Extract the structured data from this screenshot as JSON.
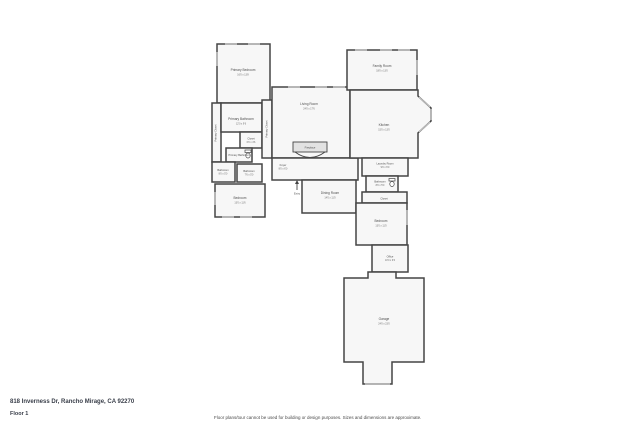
{
  "page": {
    "address": "818 Inverness Dr, Rancho Mirage, CA 92270",
    "floor_label": "Floor 1",
    "disclaimer": "Floor plans/tour cannot be used for building or design purposes. Sizes and dimensions are approximate."
  },
  "floorplan": {
    "rooms": [
      {
        "name": "Primary Bedroom",
        "dims": "16'0 x 13'8"
      },
      {
        "name": "Primary Bathroom",
        "dims": "12'0 x 9'6"
      },
      {
        "name": "Closet",
        "dims": "6'0 x 4'6"
      },
      {
        "name": "Primary Bathroom",
        "dims": ""
      },
      {
        "name": "Primary Closet",
        "dims": ""
      },
      {
        "name": "Primary Closet",
        "dims": ""
      },
      {
        "name": "Bathroom",
        "dims": "8'0 x 5'0"
      },
      {
        "name": "Bathroom",
        "dims": "7'6 x 5'0"
      },
      {
        "name": "Bedroom",
        "dims": "13'0 x 11'6"
      },
      {
        "name": "Living Room",
        "dims": "24'0 x 17'6"
      },
      {
        "name": "Fireplace",
        "dims": ""
      },
      {
        "name": "Foyer",
        "dims": "8'0 x 6'0"
      },
      {
        "name": "Entry",
        "dims": ""
      },
      {
        "name": "Dining Room",
        "dims": "14'0 x 11'0"
      },
      {
        "name": "Family Room",
        "dims": "18'0 x 13'0"
      },
      {
        "name": "Kitchen",
        "dims": "15'0 x 13'0"
      },
      {
        "name": "Laundry Room",
        "dims": "9'0 x 6'0"
      },
      {
        "name": "Bathroom",
        "dims": "8'0 x 5'0"
      },
      {
        "name": "Closet",
        "dims": ""
      },
      {
        "name": "Bedroom",
        "dims": "13'0 x 11'0"
      },
      {
        "name": "Office",
        "dims": "10'0 x 9'0"
      },
      {
        "name": "Garage",
        "dims": "24'0 x 23'0"
      }
    ]
  },
  "colors": {
    "background": "#ffffff",
    "wall": "#454545",
    "room_fill": "#f7f7f7",
    "fireplace_fill": "#e2e2e2",
    "window": "#c9c9c9",
    "label": "#4f4f4f",
    "address_text": "#3a3f4a",
    "disclaimer_text": "#4a4a4a"
  }
}
